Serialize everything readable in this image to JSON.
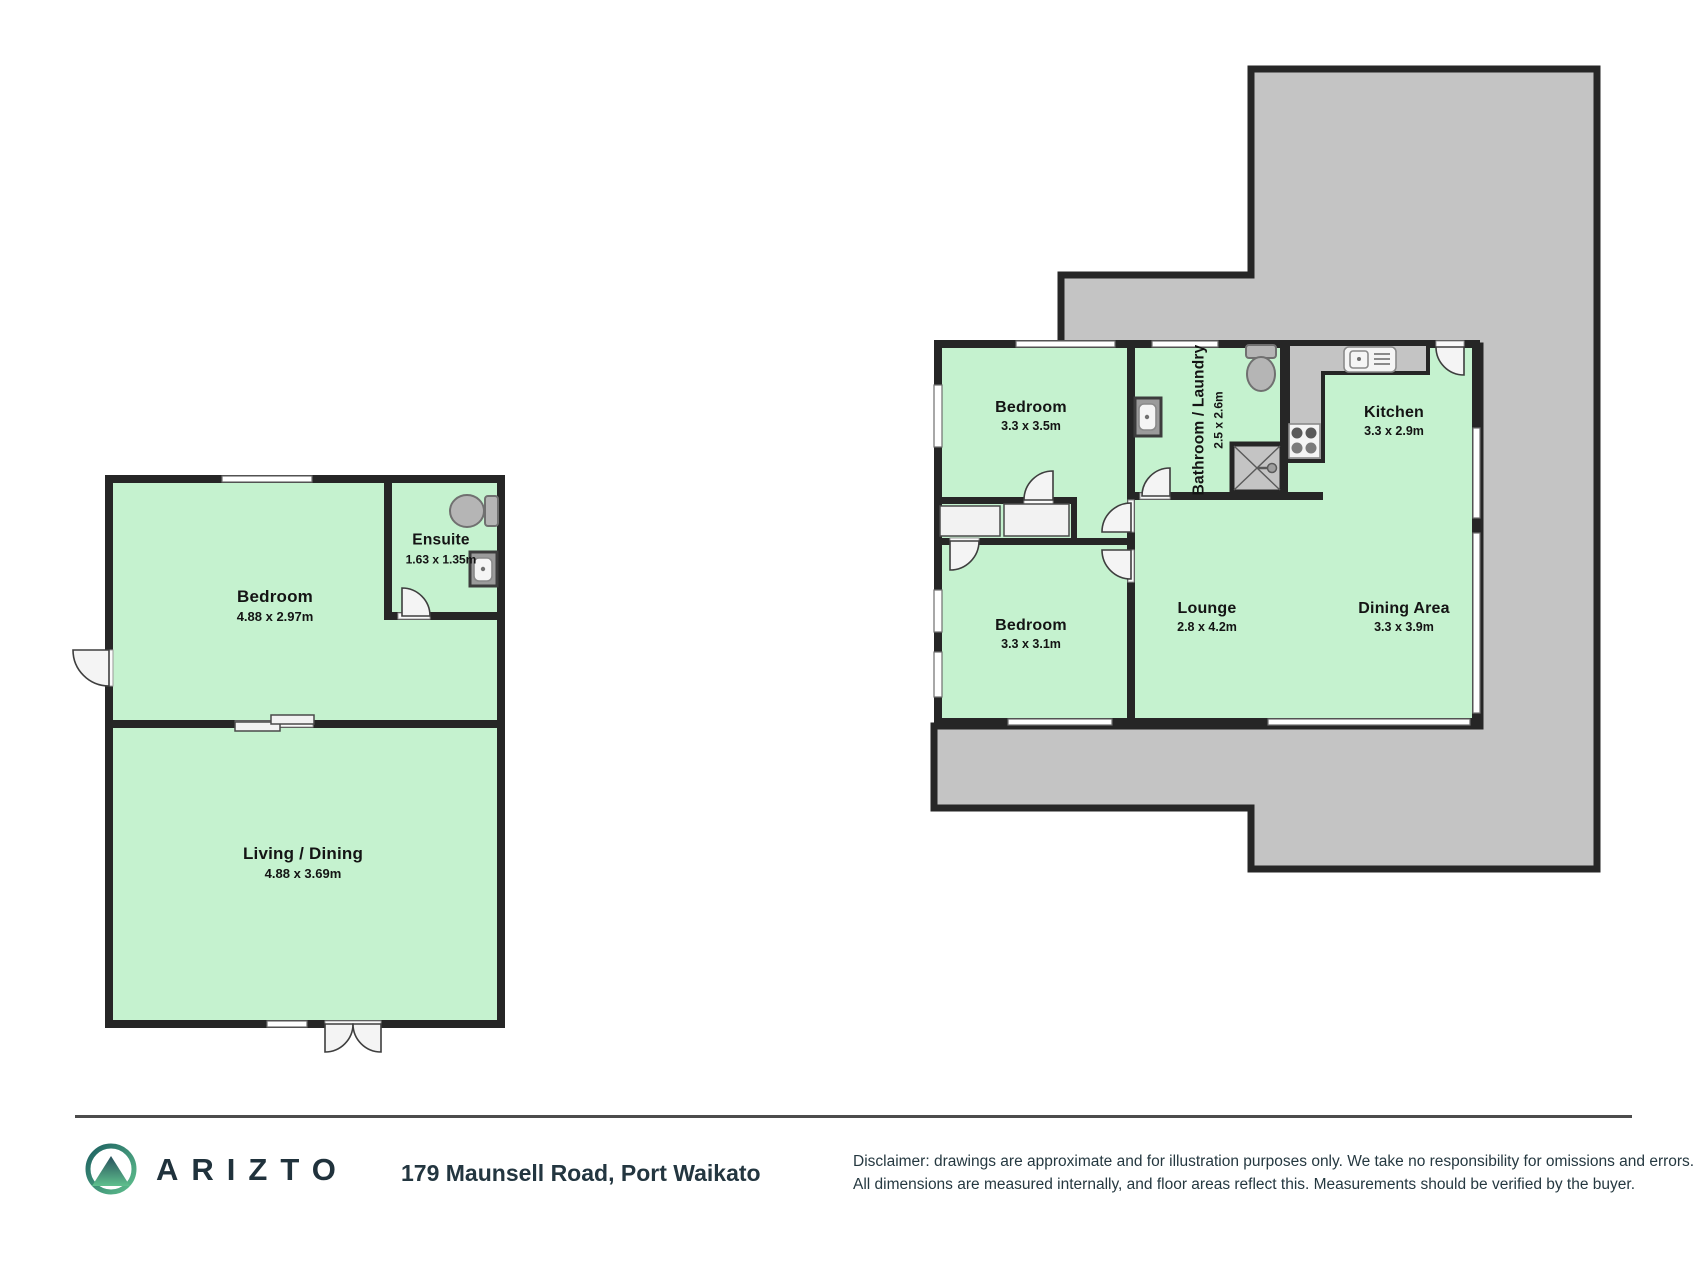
{
  "plans": {
    "left": {
      "name": "minor dwelling floor plan",
      "rooms": [
        {
          "name": "Bedroom",
          "dims": "4.88 x 2.97m"
        },
        {
          "name": "Ensuite",
          "dims": "1.63 x 1.35m"
        },
        {
          "name": "Living / Dining",
          "dims": "4.88 x 3.69m"
        }
      ]
    },
    "right": {
      "name": "main dwelling floor plan",
      "rooms": [
        {
          "name": "Bedroom",
          "dims": "3.3 x 3.5m"
        },
        {
          "name": "Bathroom / Laundry",
          "dims": "2.5 x 2.6m"
        },
        {
          "name": "Kitchen",
          "dims": "3.3 x 2.9m"
        },
        {
          "name": "Bedroom",
          "dims": "3.3 x 3.1m"
        },
        {
          "name": "Lounge",
          "dims": "2.8 x 4.2m"
        },
        {
          "name": "Dining Area",
          "dims": "3.3 x 3.9m"
        }
      ]
    }
  },
  "footer": {
    "brand": "ARIZTO",
    "address": "179 Maunsell Road, Port Waikato",
    "disclaimer_line1": "Disclaimer: drawings are approximate and for illustration purposes only. We take no responsibility for omissions and errors.",
    "disclaimer_line2": "All dimensions are measured internally, and floor areas reflect this. Measurements should be verified by the buyer."
  },
  "colors": {
    "room_fill": "#c5f2cf",
    "deck_fill": "#c4c4c4",
    "wall": "#262626",
    "window_stroke": "#6f6f6f",
    "door_fill": "#f4f4f4",
    "door_stroke": "#3e3e3e",
    "fixture_fill": "#b5b5b5",
    "fixture_stroke": "#707070",
    "divider": "#4c4c4c",
    "brand_text": "#20323c",
    "body_text": "#253840",
    "logo_teal": "#1c5f60",
    "logo_green": "#5fc08d"
  }
}
